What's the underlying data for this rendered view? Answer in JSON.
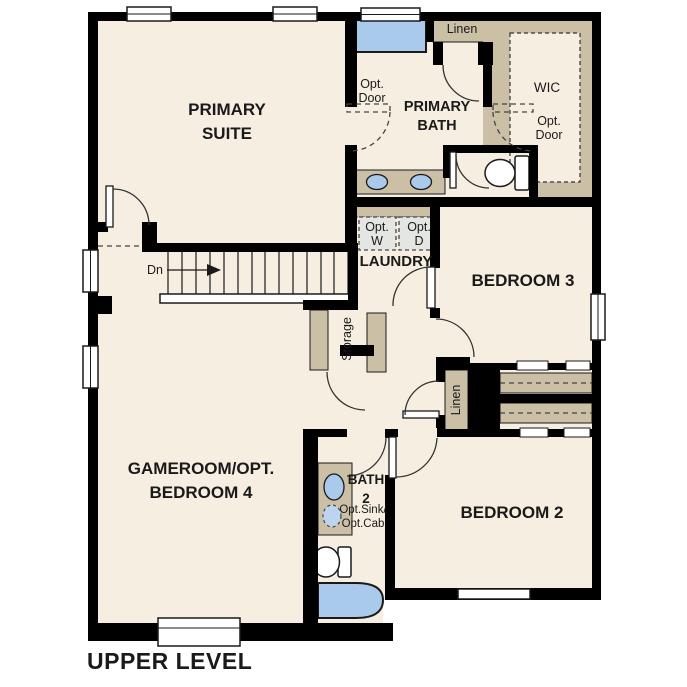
{
  "palette": {
    "page_background": "#ffffff",
    "floor": "#f6eee1",
    "wall": "#000000",
    "cabinet_tan": "#cbbfa6",
    "fixture_blue": "#a9caeb",
    "appliance_gray": "#e3e6e2",
    "line_dark": "#1a1a1a"
  },
  "plan": {
    "title": "UPPER LEVEL"
  },
  "rooms": {
    "primary_suite": "PRIMARY\nSUITE",
    "primary_bath": "PRIMARY\nBATH",
    "wic": "WIC",
    "laundry": "LAUNDRY",
    "bedroom3": "BEDROOM 3",
    "bedroom2": "BEDROOM 2",
    "gameroom": "GAMEROOM/OPT.\nBEDROOM 4",
    "bath2": "BATH\n2"
  },
  "annotations": {
    "stair_direction": "Dn",
    "opt_door_primary": "Opt.\nDoor",
    "opt_door_wic": "Opt.\nDoor",
    "linen_upper": "Linen",
    "linen_hall": "Linen",
    "storage": "Storage",
    "opt_washer": "Opt.\nW",
    "opt_dryer": "Opt.\nD",
    "opt_sink_cab": "Opt.Sink/\nOpt.Cab"
  }
}
